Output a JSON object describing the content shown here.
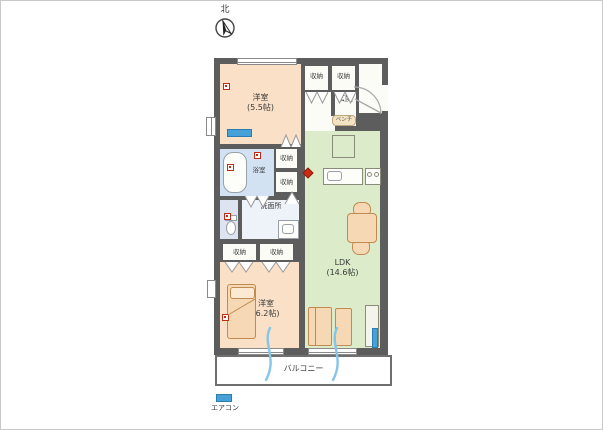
{
  "compass": {
    "label": "北"
  },
  "labels": {
    "closet": "収納",
    "bench": "ベンチ"
  },
  "rooms": {
    "bedroom_north": {
      "name": "洋室",
      "size": "(5.5帖)"
    },
    "entrance": {
      "name": "玄関"
    },
    "bathroom": {
      "name": "浴室"
    },
    "washroom": {
      "name": "洗面所"
    },
    "ldk": {
      "name": "LDK",
      "size": "(14.6帖)"
    },
    "bedroom_south": {
      "name": "洋室",
      "size": "(6.2帖)"
    },
    "balcony": {
      "name": "バルコニー"
    }
  },
  "legend": {
    "aircon": "エアコン"
  },
  "colors": {
    "wall": "#5d5d5d",
    "bedroom": "#f9e0c6",
    "ldk": "#dcecca",
    "bathroom": "#d3e2f3",
    "washroom": "#eef2f9",
    "toilet": "#dde4f0",
    "aircon": "#45a1d8",
    "alarm": "#c22c14",
    "furniture": "#f6d9b4"
  }
}
